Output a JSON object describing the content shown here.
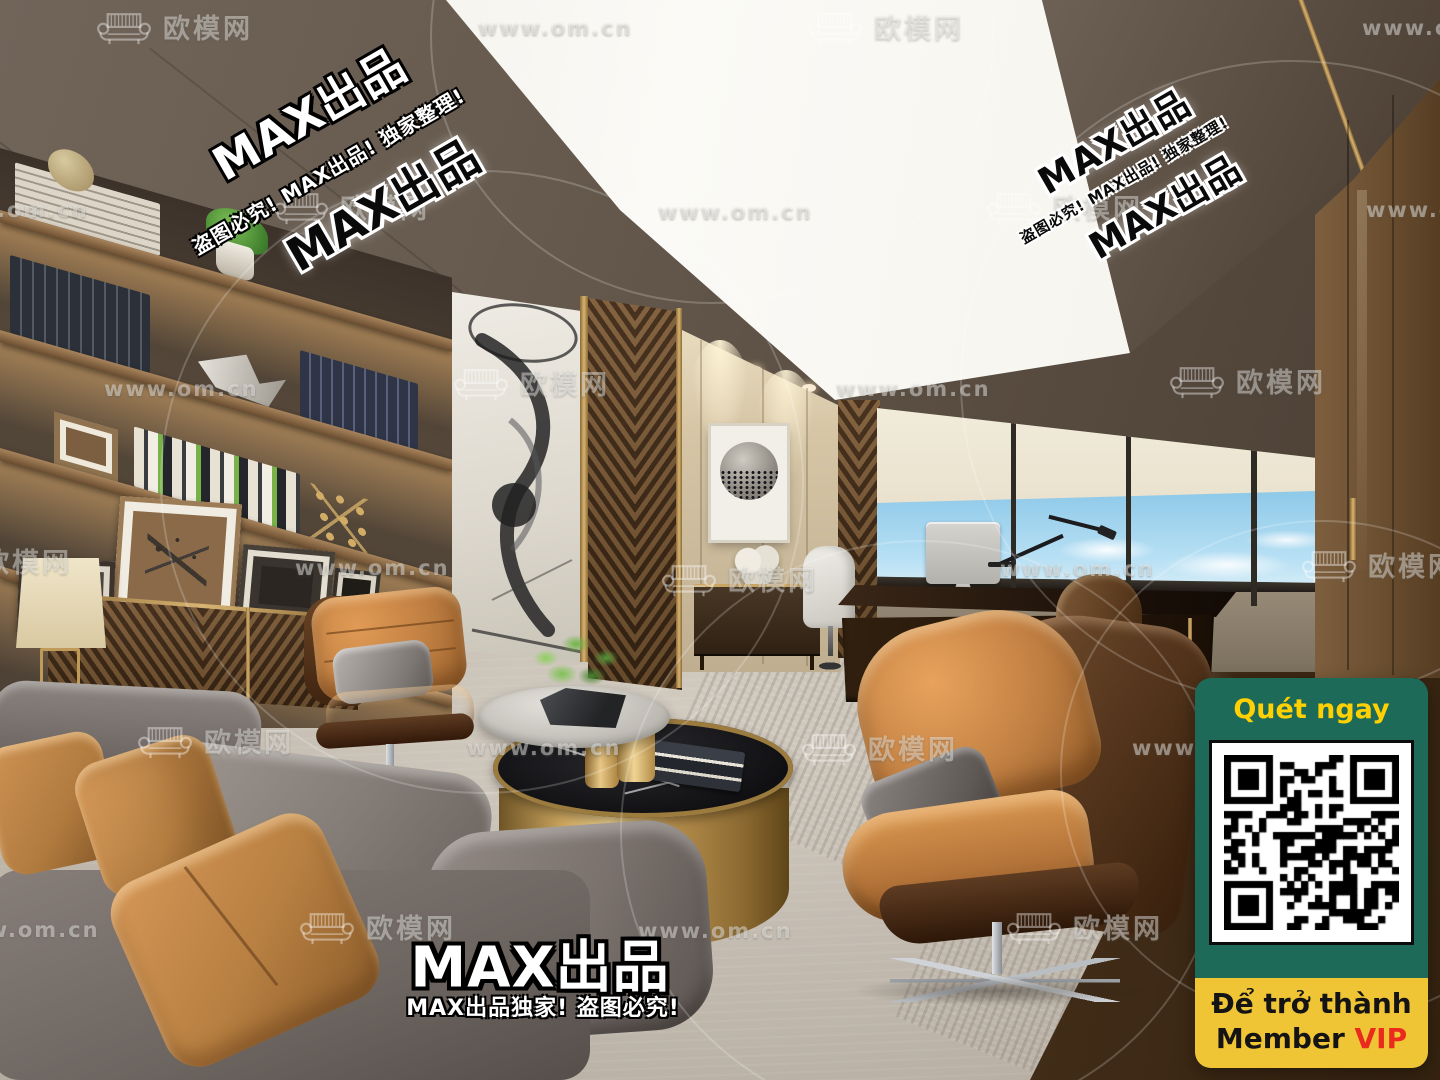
{
  "watermarks": {
    "brand": "欧模网",
    "url": "www.om.cn",
    "max": "MAX出品",
    "max_line_full": "盗图必究! MAX出品! 独家整理!",
    "max_line_bottom": "MAX出品独家! 盗图必究!",
    "tiles": [
      {
        "t": "logo",
        "x": 95,
        "y": 6
      },
      {
        "t": "url",
        "x": 478,
        "y": 16
      },
      {
        "t": "logo",
        "x": 806,
        "y": 6
      },
      {
        "t": "url",
        "x": 1362,
        "y": 16
      },
      {
        "t": "url",
        "x": -66,
        "y": 198
      },
      {
        "t": "logo",
        "x": 272,
        "y": 186
      },
      {
        "t": "url",
        "x": 658,
        "y": 200
      },
      {
        "t": "logo",
        "x": 985,
        "y": 186
      },
      {
        "t": "url",
        "x": 1366,
        "y": 198
      },
      {
        "t": "url",
        "x": 104,
        "y": 377
      },
      {
        "t": "logo",
        "x": 452,
        "y": 362
      },
      {
        "t": "url",
        "x": 836,
        "y": 377
      },
      {
        "t": "logo",
        "x": 1168,
        "y": 360
      },
      {
        "t": "logo",
        "x": -86,
        "y": 540
      },
      {
        "t": "url",
        "x": 295,
        "y": 556
      },
      {
        "t": "logo",
        "x": 660,
        "y": 558
      },
      {
        "t": "url",
        "x": 1000,
        "y": 557
      },
      {
        "t": "logo",
        "x": 1300,
        "y": 544
      },
      {
        "t": "logo",
        "x": 136,
        "y": 720
      },
      {
        "t": "url",
        "x": 467,
        "y": 736
      },
      {
        "t": "logo",
        "x": 800,
        "y": 727
      },
      {
        "t": "url",
        "x": 1132,
        "y": 736
      },
      {
        "t": "url",
        "x": -55,
        "y": 918
      },
      {
        "t": "logo",
        "x": 298,
        "y": 906
      },
      {
        "t": "url",
        "x": 638,
        "y": 919
      },
      {
        "t": "logo",
        "x": 1005,
        "y": 906
      }
    ]
  },
  "qr_panel": {
    "title": "Quét ngay",
    "line1": "Để trở thành",
    "member": "Member ",
    "vip": "VIP"
  },
  "qr": {
    "modules": 25
  },
  "colors": {
    "qr_green": "#1c6a57",
    "qr_yellow": "#f0c535",
    "title_yellow": "#ffd103",
    "vip_red": "#ea2a1e",
    "leather_orange": "#c08347",
    "sofa_gray": "#847b76",
    "brass": "#b08d4f",
    "sky_blue": "#9fd4ee"
  }
}
